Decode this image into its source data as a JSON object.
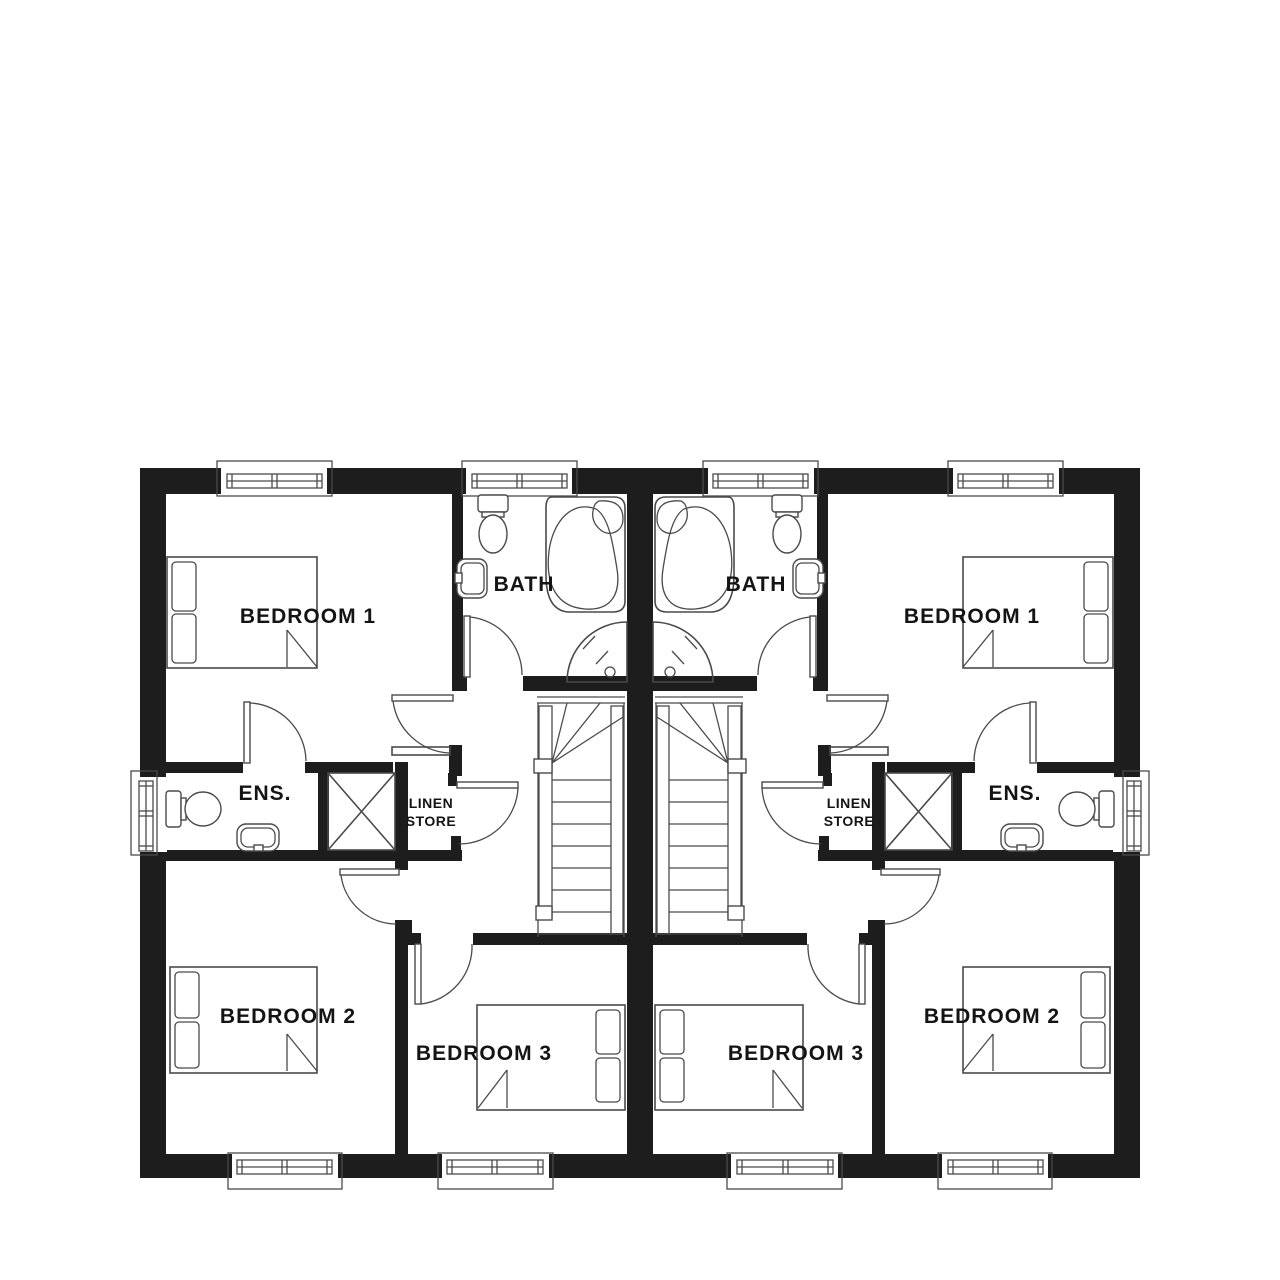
{
  "document": {
    "kind": "floor-plan",
    "style": "black-and-white architectural drawing, two mirrored semi-detached units"
  },
  "colors": {
    "wall": "#1d1d1d",
    "line": "#4a4a4a",
    "text": "#141414",
    "background": "#ffffff"
  },
  "rooms": {
    "bedroom1": {
      "label": "BEDROOM 1"
    },
    "bedroom2": {
      "label": "BEDROOM 2"
    },
    "bedroom3": {
      "label": "BEDROOM 3"
    },
    "bath": {
      "label": "BATH"
    },
    "ens": {
      "label": "ENS."
    },
    "linen": {
      "line1": "LINEN",
      "line2": "STORE"
    }
  },
  "units": [
    {
      "id": "left-unit",
      "rooms": [
        "BEDROOM 1",
        "BATH",
        "ENS.",
        "LINEN STORE",
        "BEDROOM 2",
        "BEDROOM 3"
      ]
    },
    {
      "id": "right-unit",
      "rooms": [
        "BEDROOM 1",
        "BATH",
        "ENS.",
        "LINEN STORE",
        "BEDROOM 2",
        "BEDROOM 3"
      ]
    }
  ],
  "fixtures": {
    "bath": [
      "toilet",
      "wash-basin",
      "corner-bath",
      "quadrant-shower"
    ],
    "ens": [
      "toilet",
      "wash-basin"
    ],
    "bedroom1": [
      "double-bed"
    ],
    "bedroom2": [
      "double-bed"
    ],
    "bedroom3": [
      "double-bed"
    ],
    "landing": [
      "staircase",
      "linen-cupboard"
    ]
  }
}
